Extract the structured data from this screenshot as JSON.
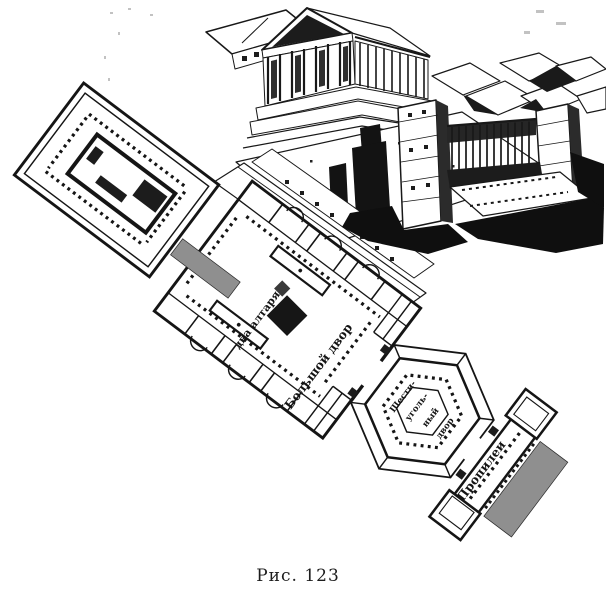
{
  "figure": {
    "caption": "Рис. 123",
    "plan": {
      "label_altars": "два алтаря",
      "label_great_court": "Большой двор",
      "label_hex_court": [
        "Шести-",
        "уголь-",
        "ный",
        "двор"
      ],
      "label_propylaea": "Пропилеи"
    },
    "colors": {
      "ink": "#181818",
      "paper": "#ffffff",
      "stair_gray": "#8f8f8f"
    }
  }
}
